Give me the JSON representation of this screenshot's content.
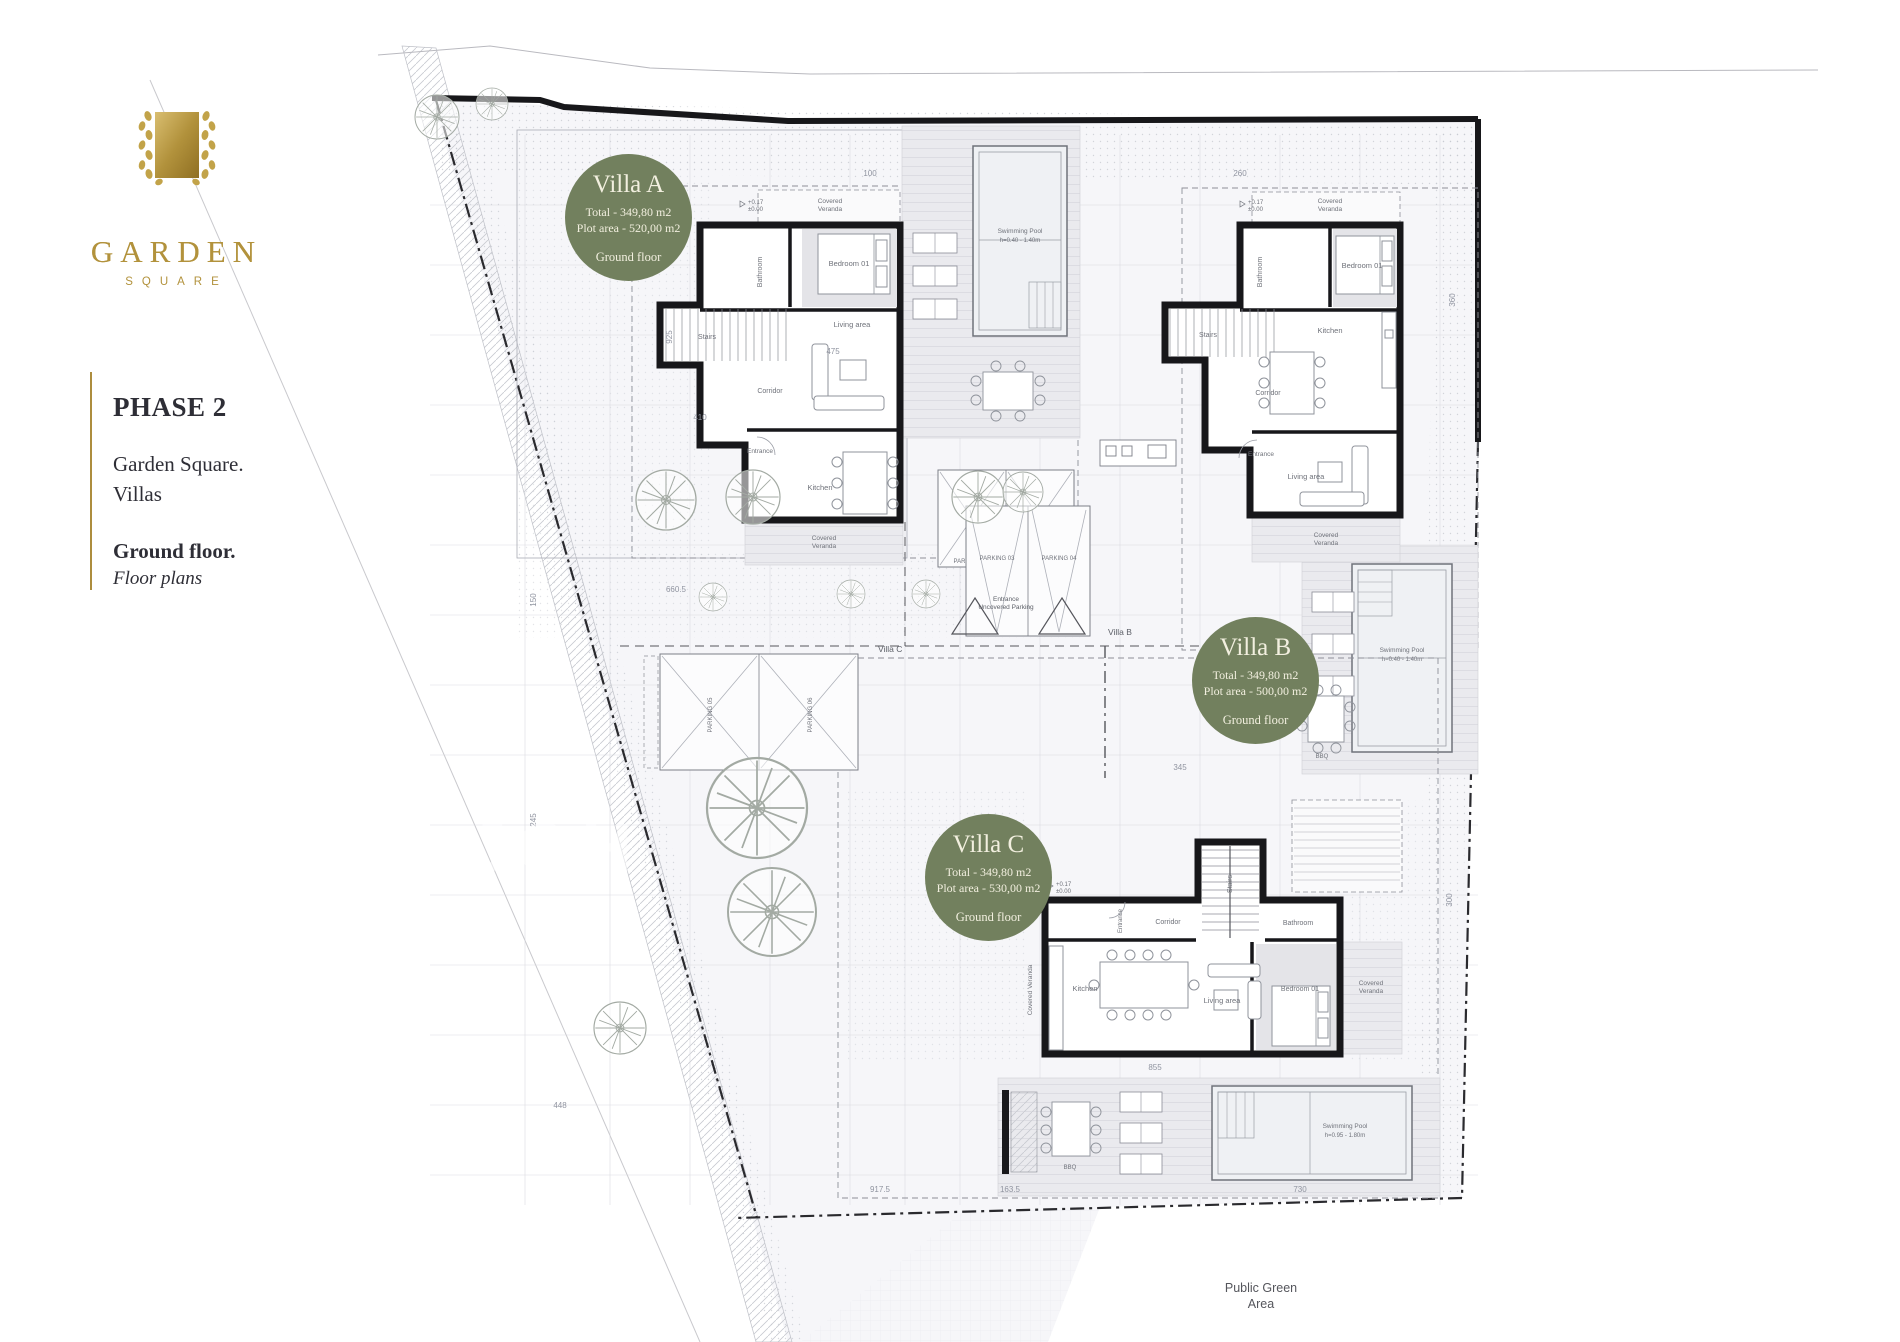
{
  "brand": {
    "name": "GARDEN",
    "sub": "SQUARE"
  },
  "sidebar": {
    "phase": "PHASE 2",
    "project_line1": "Garden Square.",
    "project_line2": "Villas",
    "floor_title": "Ground floor.",
    "floor_subtitle": "Floor plans"
  },
  "badges": [
    {
      "villa": "Villa A",
      "total": "Total - 349,80 m2",
      "plot": "Plot area - 520,00 m2",
      "floor": "Ground floor"
    },
    {
      "villa": "Villa B",
      "total": "Total - 349,80 m2",
      "plot": "Plot area - 500,00 m2",
      "floor": "Ground floor"
    },
    {
      "villa": "Villa C",
      "total": "Total - 349,80 m2",
      "plot": "Plot area - 530,00 m2",
      "floor": "Ground floor"
    }
  ],
  "rooms": {
    "veranda1": "Covered",
    "veranda2": "Veranda",
    "veranda": "Covered Veranda",
    "bedroom": "Bedroom 01",
    "bathroom": "Bathroom",
    "stairs": "Stairs",
    "corridor": "Corridor",
    "entrance": "Entrance",
    "living": "Living area",
    "kitchen": "Kitchen"
  },
  "pools": {
    "name": "Swimming Pool",
    "depth_ab": "h=0.40 - 1.40m",
    "depth_c": "h=0.95 - 1.80m"
  },
  "site": {
    "public_green_1": "Public Green",
    "public_green_2": "Area",
    "entrance_1": "Entrance",
    "entrance_2": "Uncovered Parking",
    "villa_b_tag": "Villa B",
    "villa_c_tag": "Villa C",
    "bbq": "BBQ",
    "watermark": "JOH"
  },
  "parking": {
    "p1": "PARKING 01",
    "p2": "PARKING 02",
    "p3": "PARKING 03",
    "p4": "PARKING 04",
    "p5": "PARKING 05",
    "p6": "PARKING 06"
  },
  "levels": {
    "l1": "+0.17",
    "l2": "±0.00",
    "l3": "+0.20"
  },
  "dimensions": [
    "360",
    "100",
    "260",
    "660.5",
    "917.5",
    "730",
    "475",
    "345",
    "163.5",
    "150",
    "245",
    "410",
    "925",
    "448",
    "855",
    "300"
  ],
  "colors": {
    "badge_green": "#72805e",
    "logo_gold": "#b2923c",
    "wall": "#17171a",
    "deck": "#eaeaee",
    "site_fill": "#f6f6f9",
    "label": "#6f727a"
  }
}
